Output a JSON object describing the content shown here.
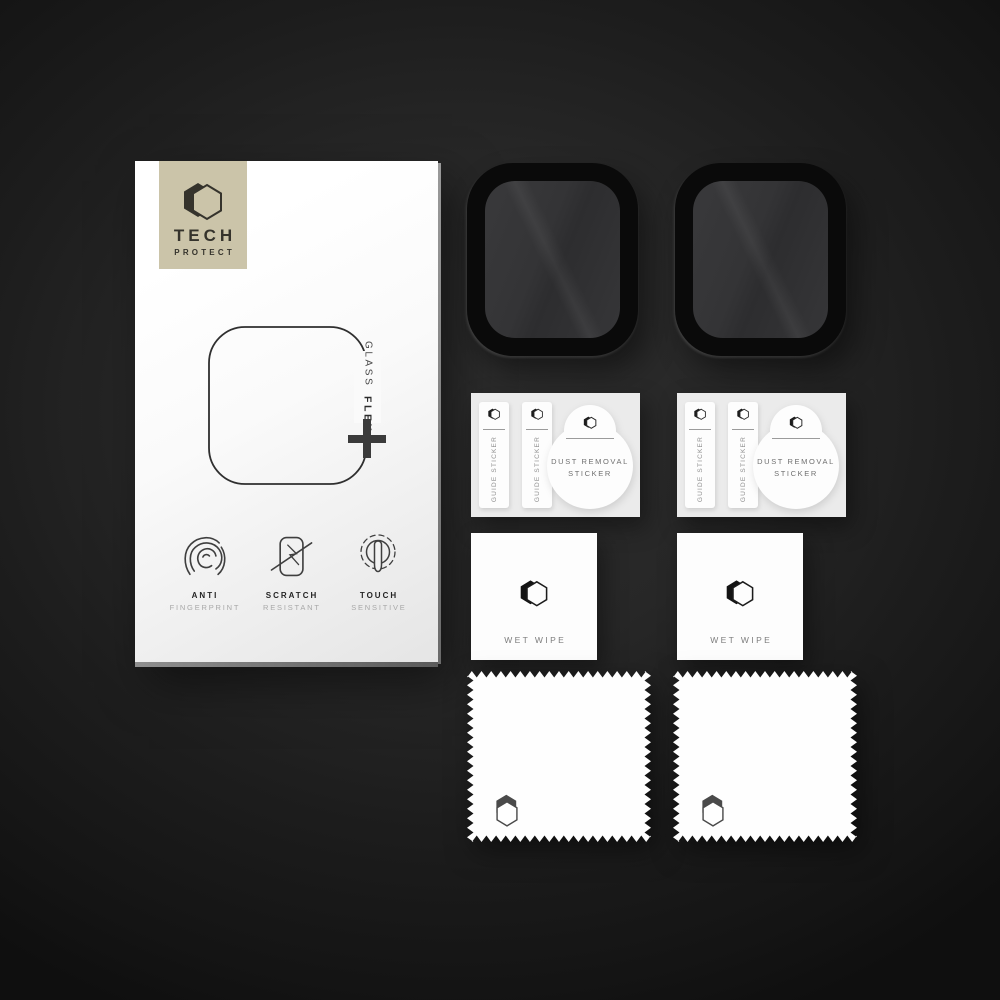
{
  "background": {
    "vignette_center": "#2d2d2d",
    "vignette_edge": "#0f0f0f"
  },
  "package_box": {
    "brand": {
      "line1": "TECH",
      "line2": "PROTECT",
      "logo_icon": "hexagon-logo",
      "panel_color": "#cbc4a9",
      "text_color": "#35332c"
    },
    "product_mark": {
      "word_regular": "GLASS",
      "word_bold": "FLEX",
      "plus_icon": "plus-icon"
    },
    "features": [
      {
        "icon": "fingerprint-icon",
        "title": "ANTI",
        "subtitle": "FINGERPRINT"
      },
      {
        "icon": "scratch-icon",
        "title": "SCRATCH",
        "subtitle": "RESISTANT"
      },
      {
        "icon": "touch-icon",
        "title": "TOUCH",
        "subtitle": "SENSITIVE"
      }
    ]
  },
  "screen_protectors": [
    {
      "name": "watch-glass-protector",
      "frame_color": "#0a0a0a"
    },
    {
      "name": "watch-glass-protector",
      "frame_color": "#0a0a0a"
    }
  ],
  "sticker_sheets": [
    {
      "guide_sticker_1": "GUIDE STICKER",
      "guide_sticker_2": "GUIDE STICKER",
      "dust_removal": "DUST REMOVAL STICKER"
    },
    {
      "guide_sticker_1": "GUIDE STICKER",
      "guide_sticker_2": "GUIDE STICKER",
      "dust_removal": "DUST REMOVAL STICKER"
    }
  ],
  "wet_wipes": [
    {
      "label": "WET WIPE"
    },
    {
      "label": "WET WIPE"
    }
  ],
  "cleaning_cloths": [
    {
      "name": "microfiber-cloth"
    },
    {
      "name": "microfiber-cloth"
    }
  ]
}
